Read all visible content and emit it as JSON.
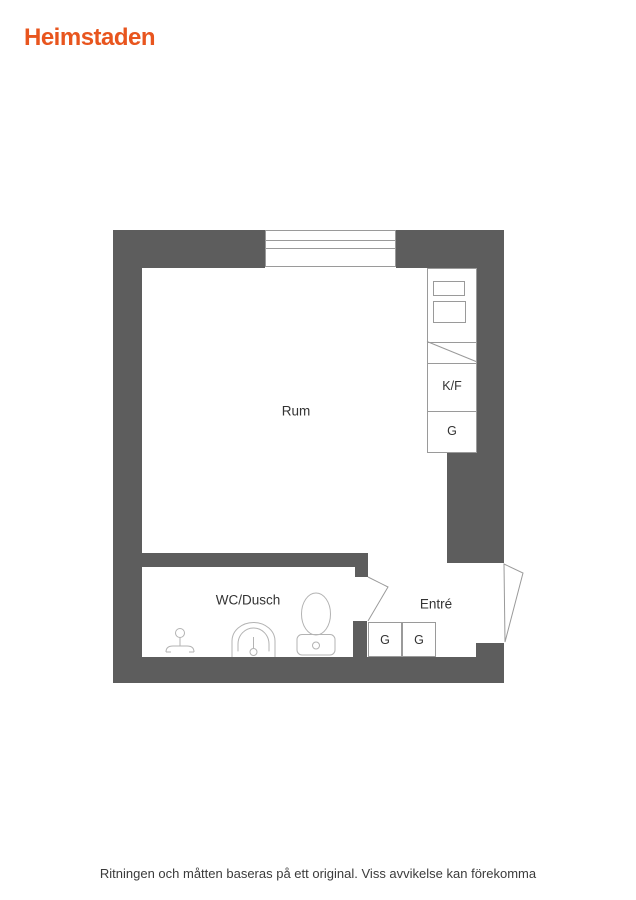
{
  "brand": {
    "logo_text": "Heimstaden",
    "logo_color": "#e8551e"
  },
  "floorplan": {
    "rooms": {
      "rum_label": "Rum",
      "wc_label": "WC/Dusch",
      "entre_label": "Entré"
    },
    "kitchen": {
      "kf_label": "K/F",
      "g_label": "G"
    },
    "entre_closets": {
      "g1_label": "G",
      "g2_label": "G"
    },
    "icons": [
      "window-symbol",
      "kitchen-counter-diagonal",
      "shower-icon",
      "sink-icon",
      "toilet-icon",
      "door-swing-wc",
      "door-swing-entry"
    ],
    "colors": {
      "wall": "#5d5d5d",
      "line": "#9a9a9a",
      "fixture": "#b3b3b3",
      "text": "#333333"
    }
  },
  "footer": {
    "disclaimer": "Ritningen och måtten baseras på ett original. Viss avvikelse kan förekomma"
  }
}
